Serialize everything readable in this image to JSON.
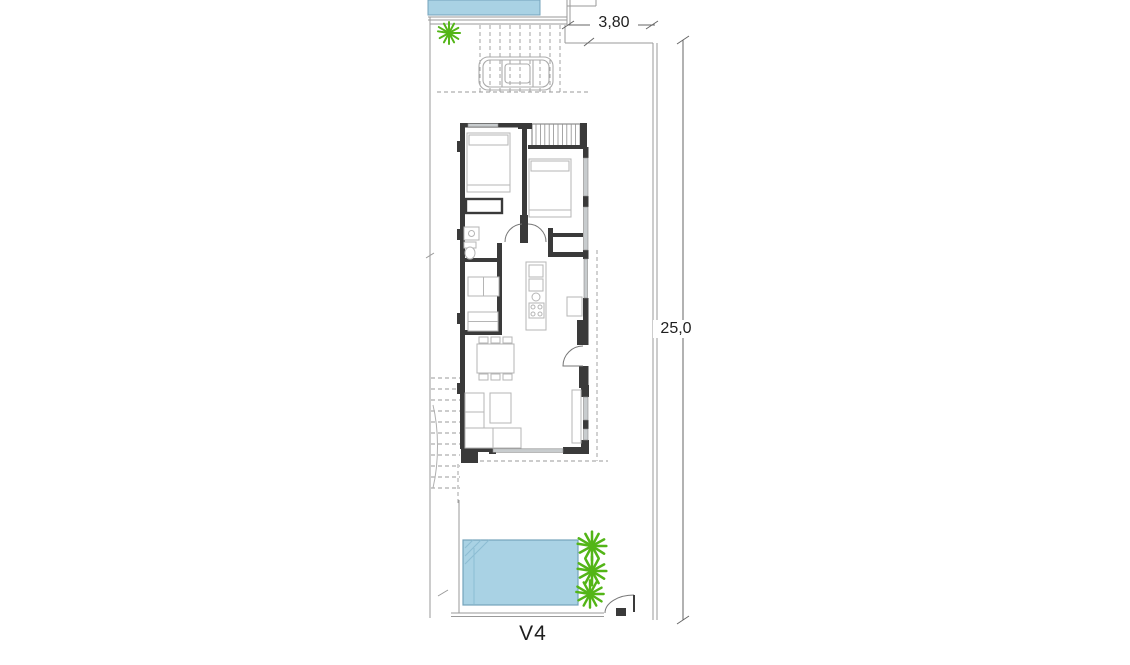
{
  "plan": {
    "unit_label": "V4",
    "dimensions": {
      "plot_width": "3,80",
      "plot_depth": "25,0"
    },
    "colors": {
      "pool_fill": "#a9d2e4",
      "pool_edge": "#74a3bb",
      "pool_detail": "#8cbdd3",
      "plant_green": "#53b517",
      "wall_dark": "#3a3a3a",
      "boundary_gray": "#9a9a9a",
      "furniture_gray": "#b5b5b5",
      "window_fill": "#c8ccce",
      "dimension_gray": "#666666",
      "car_outline": "#ababab",
      "label_text": "#1f1f1f"
    },
    "icons": {
      "plant": "plant-icon",
      "car": "car-icon",
      "door_swing": "door-swing-icon",
      "stairs": "stairs-icon"
    }
  }
}
